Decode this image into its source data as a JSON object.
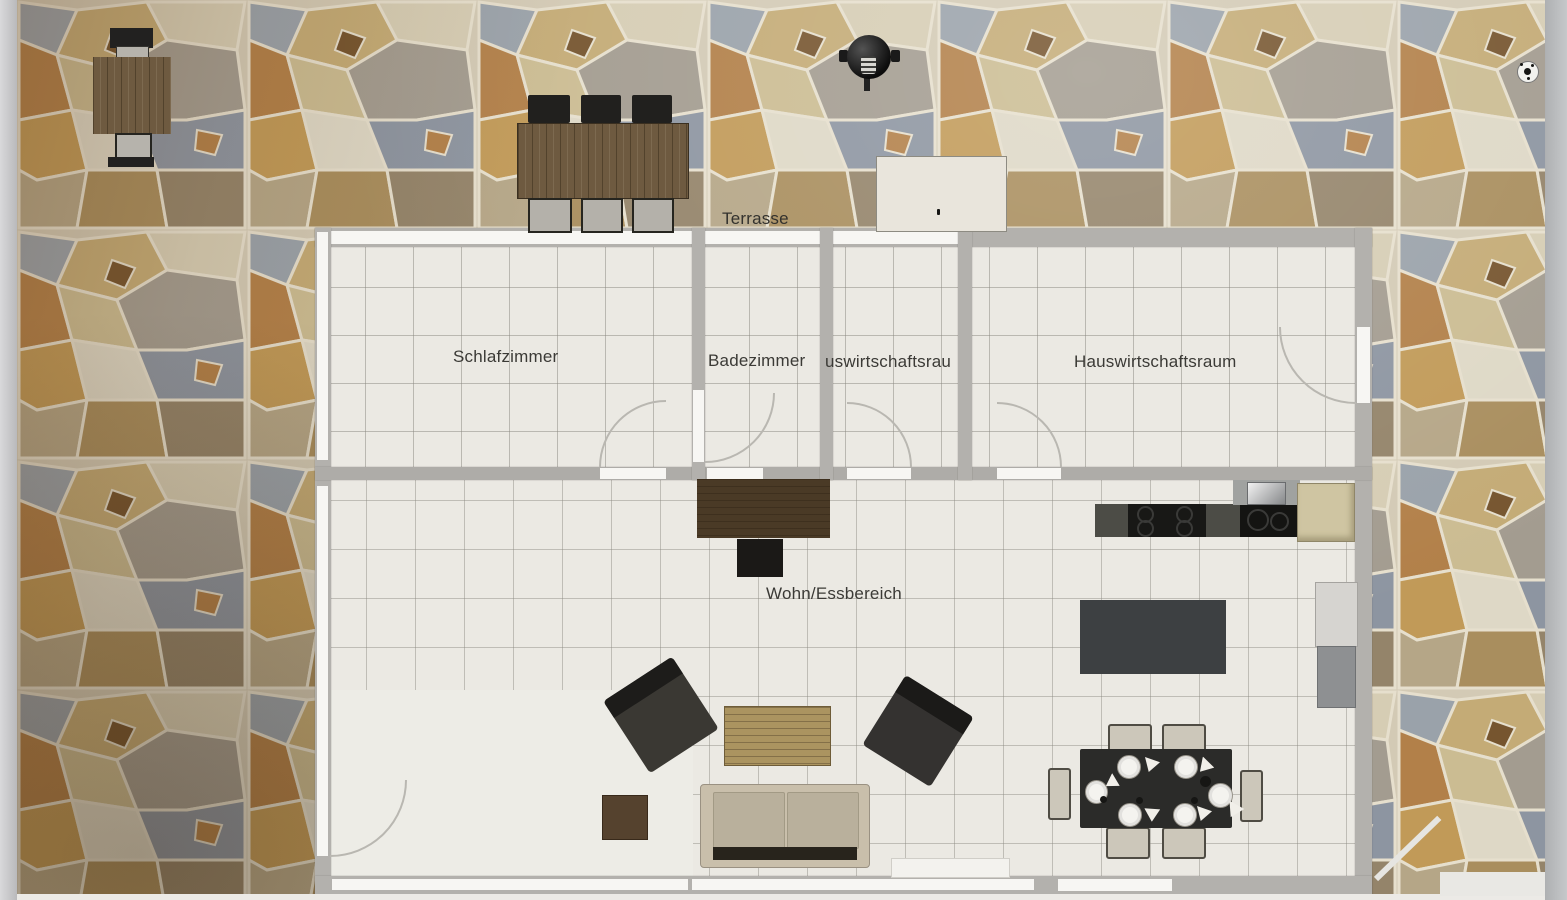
{
  "plan": {
    "type": "floor-plan-photo",
    "labels": {
      "terrasse": "Terrasse",
      "schlafzimmer": "Schlafzimmer",
      "badezimmer": "Badezimmer",
      "hauswirtschaftsraum_klein": "uswirtschaftsrau",
      "hauswirtschaftsraum": "Hauswirtschaftsraum",
      "wohn_essbereich": "Wohn/Essbereich"
    },
    "colors": {
      "wall": "#b3b1ad",
      "window": "#f7f6f3",
      "floor": "#ebe9e3",
      "floor_grid": "#8a8880",
      "stone_mortar": "#d3cab5",
      "label_text": "#3b3a36",
      "dark_furniture": "#2b2b29",
      "wood_dark": "#4e3d29",
      "wood_light": "#ac9660"
    },
    "objects": {
      "terrace": [
        "patio-table",
        "patio-chair",
        "patio-chair",
        "outdoor-dining-table",
        "outdoor-chair-x6",
        "kettle-grill",
        "storage-box",
        "soccer-ball"
      ],
      "interior": [
        "kitchen-counter",
        "cooktop",
        "sink",
        "fridge-cabinet",
        "sideboard",
        "tv",
        "rug",
        "washer",
        "dryer",
        "armchair-left",
        "armchair-right",
        "coffee-table",
        "side-table",
        "sofa",
        "dining-table",
        "dining-chair-x6",
        "doormat",
        "leaning-plank"
      ]
    }
  }
}
